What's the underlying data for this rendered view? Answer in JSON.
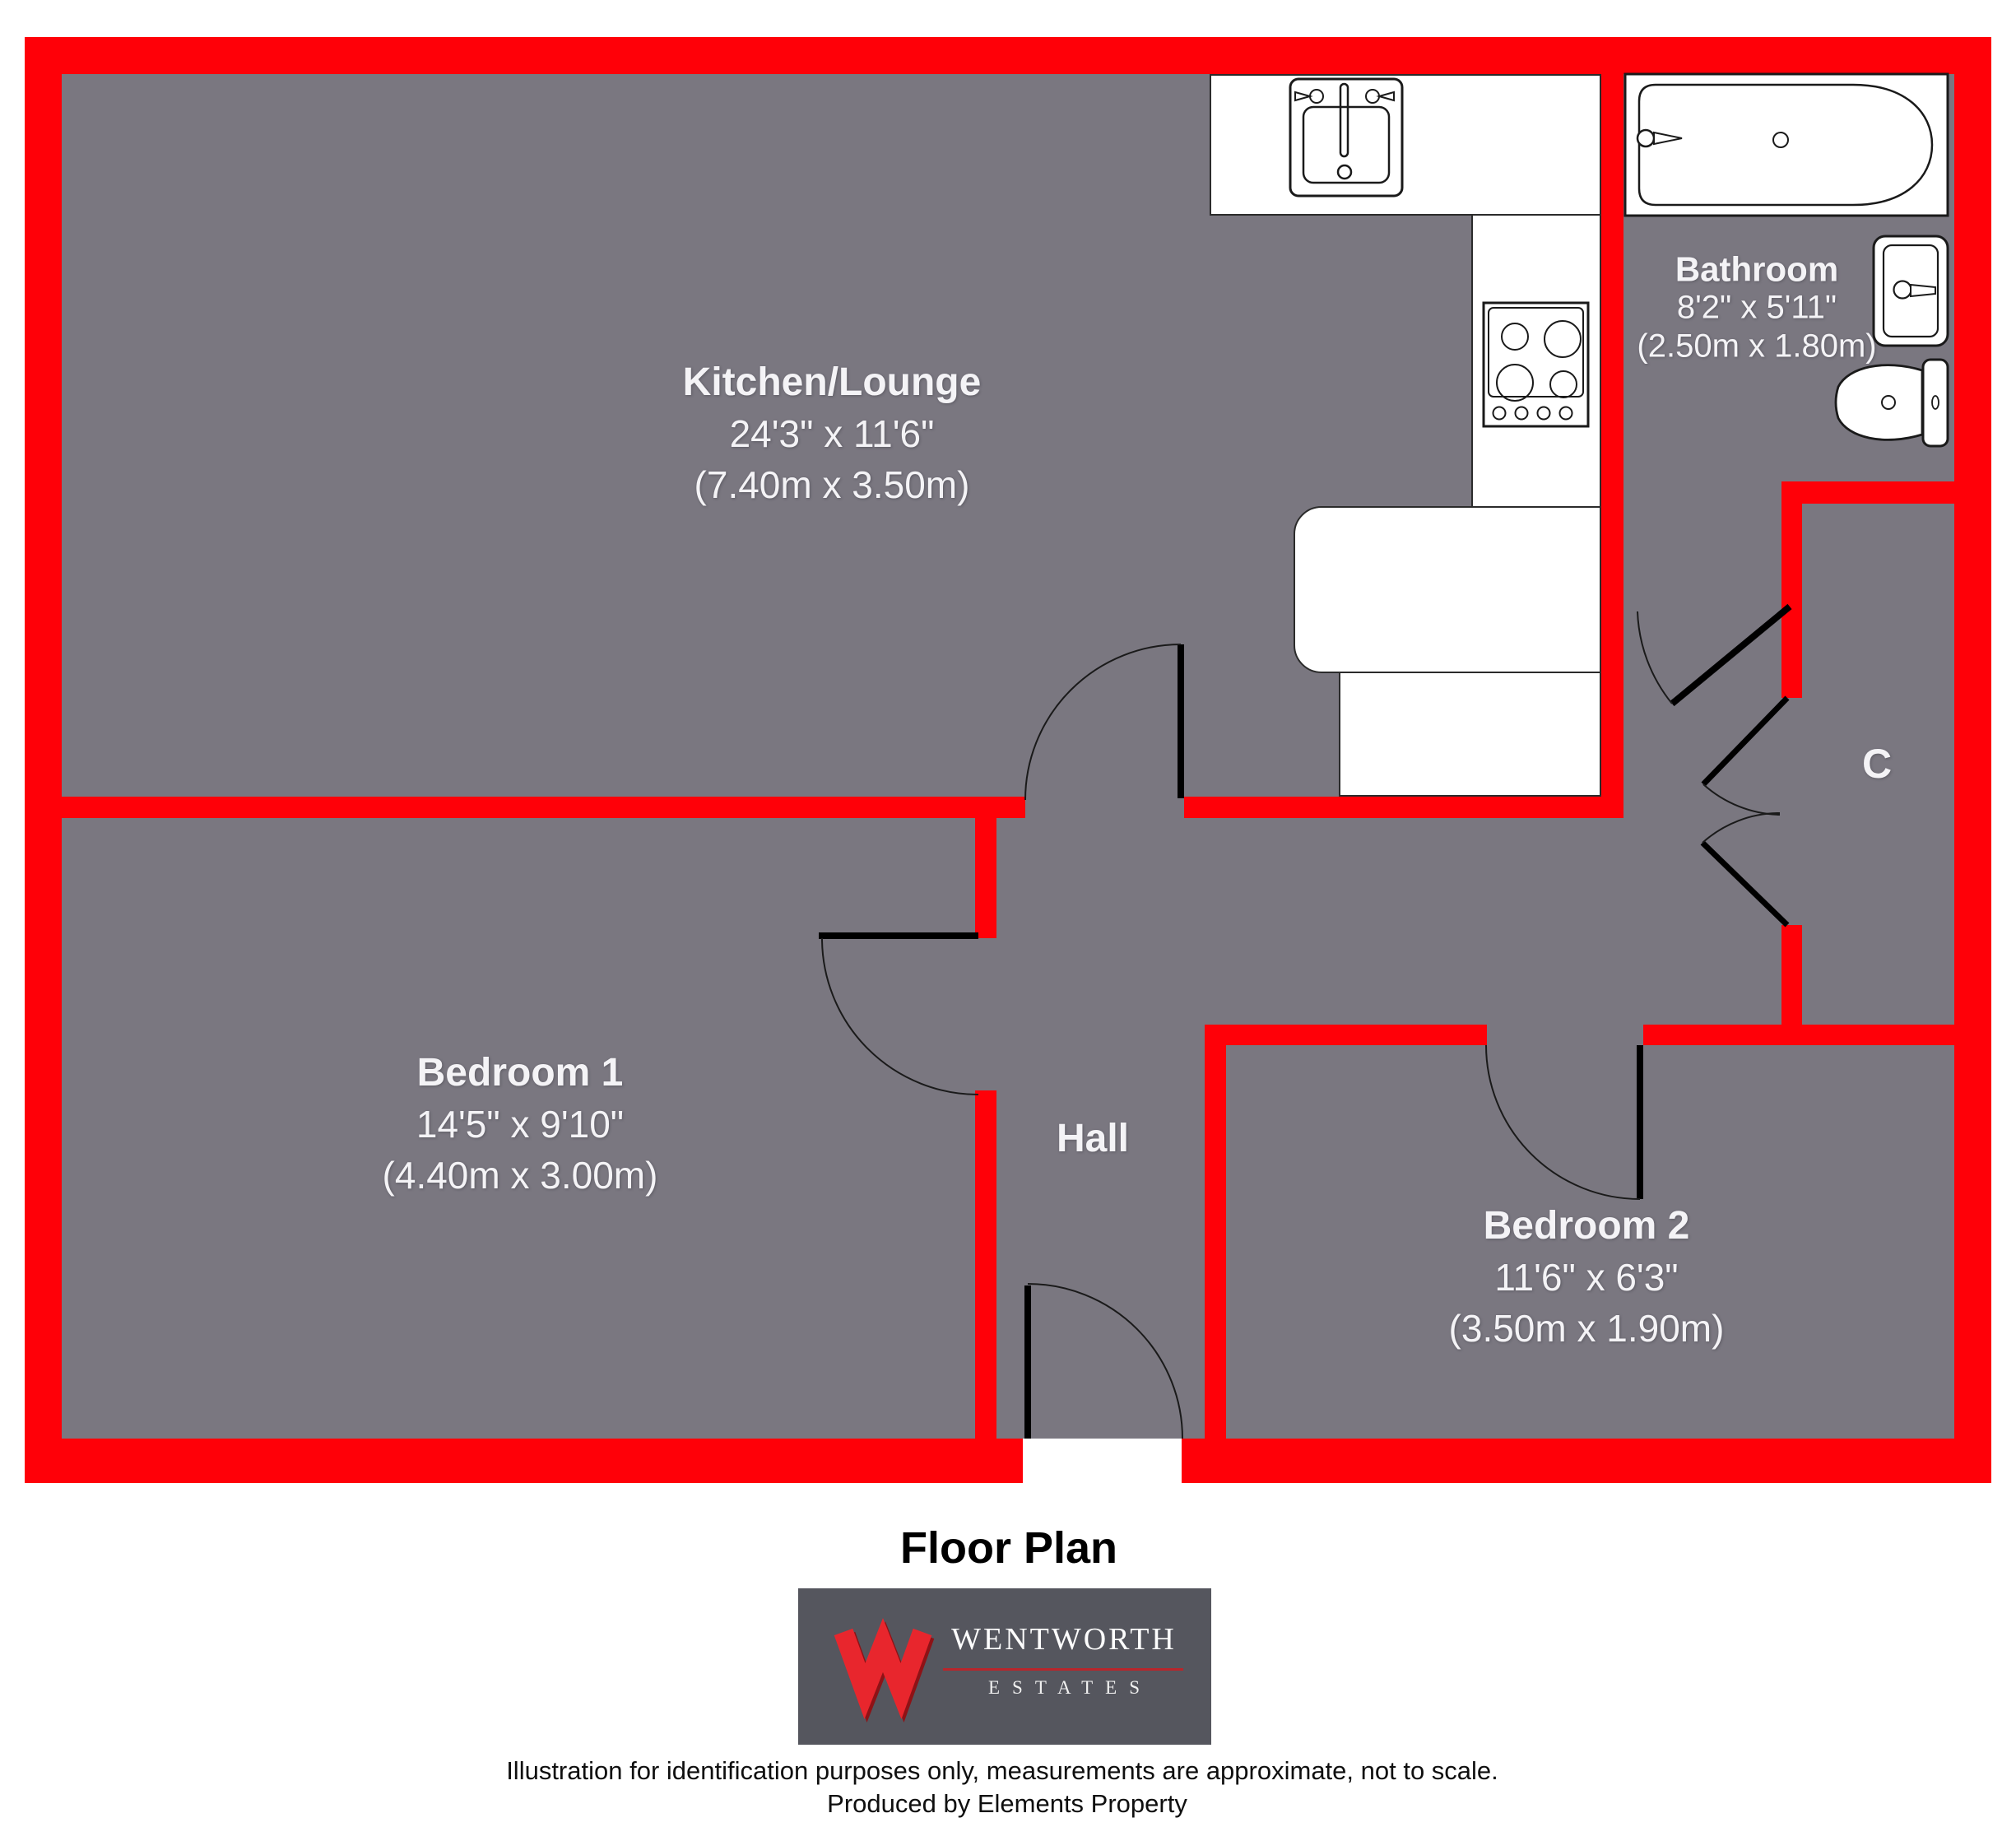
{
  "title": "Floor Plan",
  "rooms": {
    "kitchen_lounge": {
      "name": "Kitchen/Lounge",
      "imperial": "24'3\" x 11'6\"",
      "metric": "(7.40m x 3.50m)"
    },
    "bedroom_1": {
      "name": "Bedroom 1",
      "imperial": "14'5\" x 9'10\"",
      "metric": "(4.40m x 3.00m)"
    },
    "bedroom_2": {
      "name": "Bedroom 2",
      "imperial": "11'6\" x 6'3\"",
      "metric": "(3.50m x 1.90m)"
    },
    "bathroom": {
      "name": "Bathroom",
      "imperial": "8'2\" x 5'11\"",
      "metric": "(2.50m x 1.80m)"
    },
    "hall": {
      "name": "Hall"
    },
    "cupboard": {
      "name": "C"
    }
  },
  "branding": {
    "agency_name": "WENTWORTH",
    "agency_subtitle": "ESTATES"
  },
  "footer": {
    "disclaimer": "Illustration for identification purposes only, measurements are approximate, not to scale.",
    "produced_by": "Produced by Elements Property"
  },
  "colors": {
    "wall_red": "#ff0008",
    "floor_gray": "#7a7780",
    "counter_white": "#ffffff",
    "label_white": "#f4f3f6",
    "logo_background": "#55565e",
    "logo_red": "#e8262d",
    "title_black": "#000000"
  }
}
